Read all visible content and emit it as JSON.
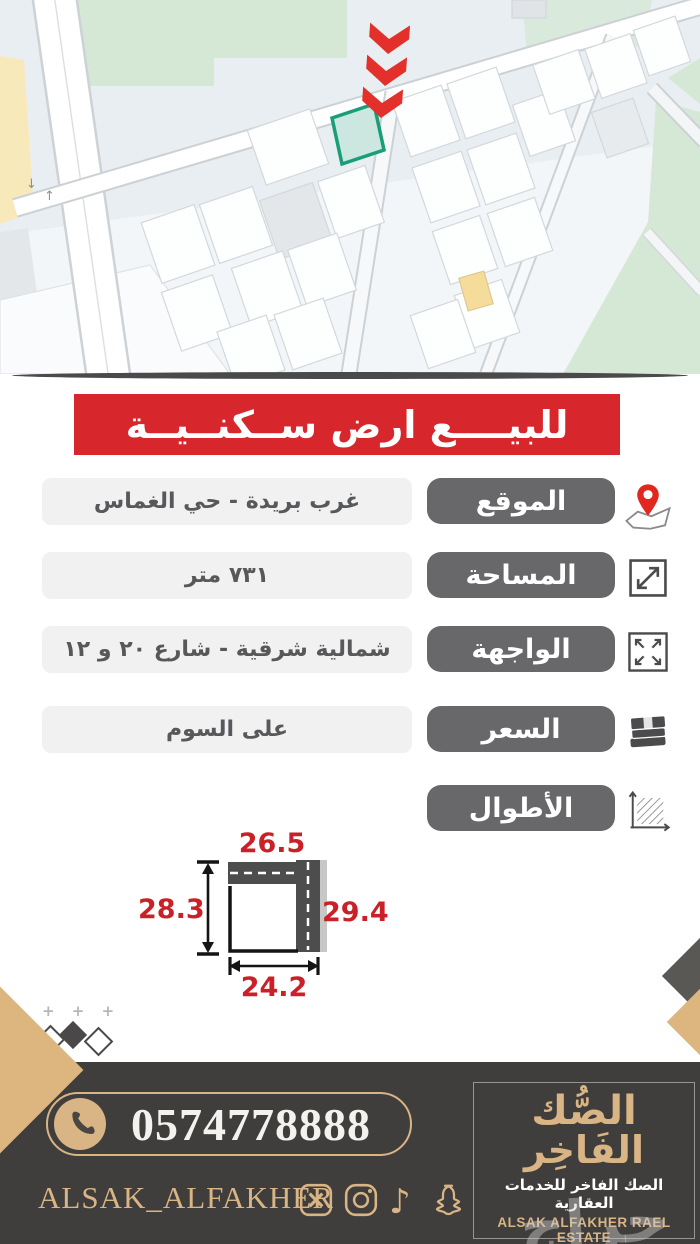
{
  "colors": {
    "banner_red": "#d7262c",
    "label_gray": "#686769",
    "value_bg": "#f1f1f2",
    "footer_bg": "#403e3d",
    "gold": "#d9b484",
    "dimension_red": "#c92127",
    "plot_fill": "#cbe7e0",
    "plot_border": "#199e77",
    "map_green": "#d5e8d6",
    "map_yellow": "#f8e9bb",
    "road_dark": "#4e4d4d",
    "arrow_red": "#e3302b"
  },
  "map": {
    "traffic": [
      "↓",
      "↑"
    ]
  },
  "banner": {
    "title": "للبيــــع ارض ســكنــيــة"
  },
  "rows": [
    {
      "label": "الموقع",
      "value": "غرب بريدة - حي الغماس",
      "icon": "map-pin-icon"
    },
    {
      "label": "المساحة",
      "value": "٧٣١ متر",
      "icon": "area-resize-icon"
    },
    {
      "label": "الواجهة",
      "value": "شمالية شرقية - شارع ٢٠ و ١٢",
      "icon": "expand-arrows-icon"
    },
    {
      "label": "السعر",
      "value": "على السوم",
      "icon": "money-icon"
    },
    {
      "label": "الأطوال",
      "icon": "dimensions-icon"
    }
  ],
  "diagram": {
    "top": "26.5",
    "left": "28.3",
    "right": "29.4",
    "bottom": "24.2"
  },
  "decorations": {
    "plus_marks": "+ + +"
  },
  "footer": {
    "phone": "0574778888",
    "handle": "ALSAK_ALFAKHER",
    "social": [
      {
        "name": "x-twitter-icon"
      },
      {
        "name": "instagram-icon"
      },
      {
        "name": "tiktok-icon",
        "glyph": "♪"
      },
      {
        "name": "snapchat-icon"
      }
    ],
    "logo": {
      "line1": "الصُّك",
      "line2": "الفَاخِر",
      "subtitle_ar": "الصك الفاخر للخدمات العقارية",
      "subtitle_en": "ALSAK ALFAKHER RAEL ESTATE"
    },
    "watermark": "حراج"
  }
}
